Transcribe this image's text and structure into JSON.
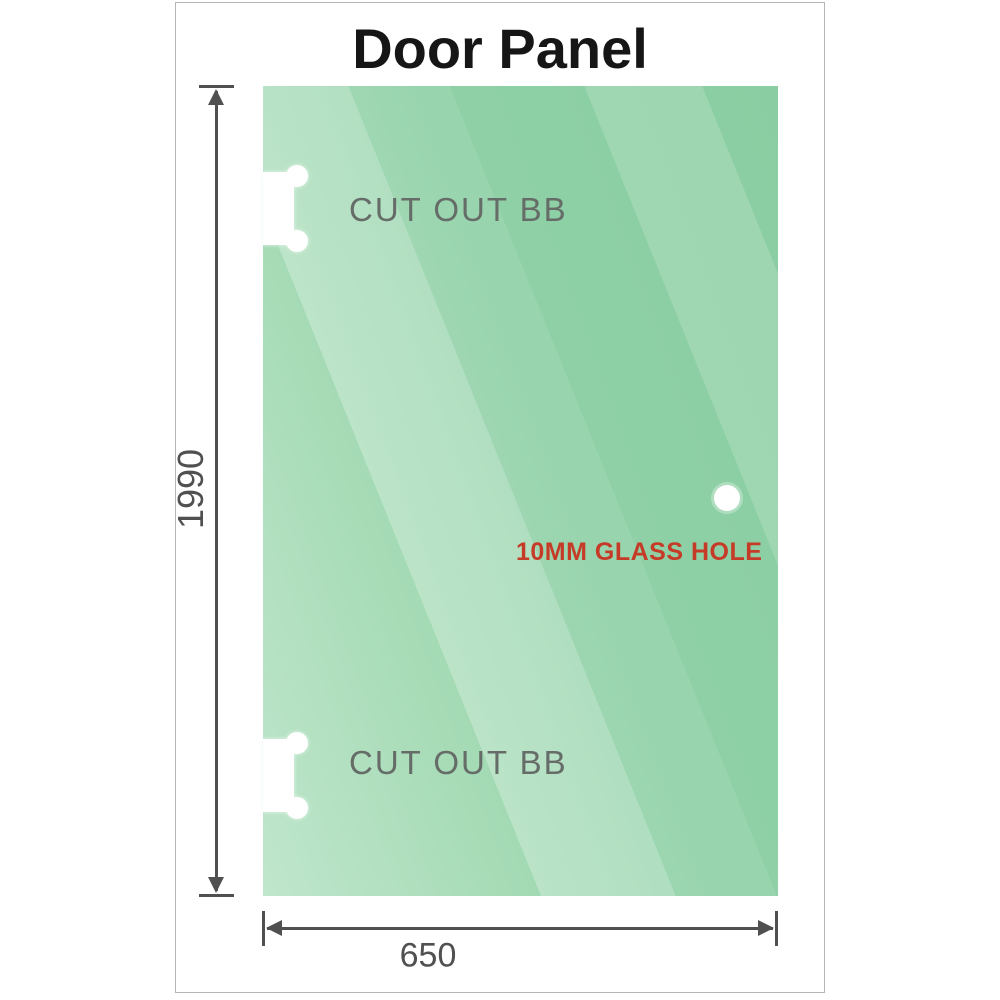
{
  "title": "Door Panel",
  "glass_panel": {
    "cutouts": [
      {
        "label": "CUT OUT BB",
        "position": "top-left"
      },
      {
        "label": "CUT OUT BB",
        "position": "bottom-left"
      }
    ],
    "glass_hole": {
      "label": "10MM GLASS HOLE"
    }
  },
  "dimensions": {
    "height": {
      "value": "1990"
    },
    "width": {
      "value": "650"
    }
  },
  "colors": {
    "glass-green": "#90d1a7",
    "glass-green-dark": "#8acda2",
    "glass-green-light": "#c0e6cc",
    "dimension-gray": "#505050",
    "cutout-label-gray": "#666c68",
    "hole-label-red": "#c53b27",
    "title-black": "#161616",
    "frame-border-gray": "#b5b5b5"
  }
}
